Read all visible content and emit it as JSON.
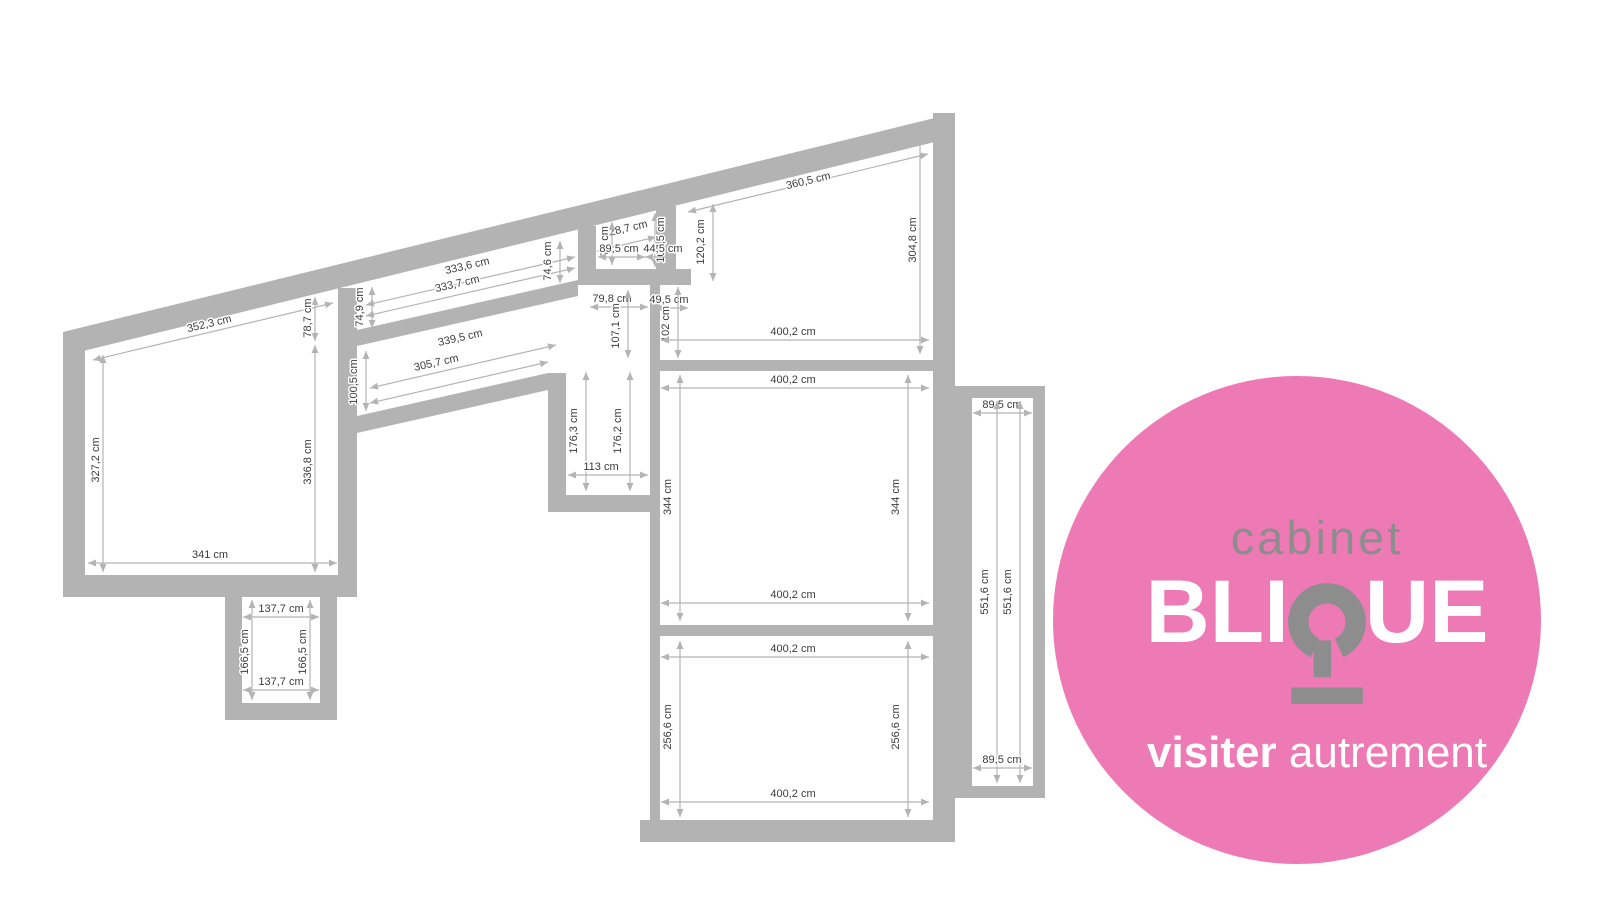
{
  "theme": {
    "pink": "#ee7ab5",
    "logo_gray": "#8d8d8d",
    "wall": "#b3b3b3",
    "dim_line": "#b4b4b4",
    "dim_text": "#3b3b3b"
  },
  "floorplan": {
    "unit": "cm",
    "dimensions": [
      {
        "label": "352,3 cm",
        "x1": 93,
        "y1": 360,
        "x2": 333,
        "y2": 303,
        "tx": 210,
        "ty": 327,
        "rot": -13.3
      },
      {
        "label": "78,7 cm",
        "x1": 315,
        "y1": 297,
        "x2": 315,
        "y2": 341,
        "tx": 311,
        "ty": 318,
        "rot": -90
      },
      {
        "label": "327,2 cm",
        "x1": 103,
        "y1": 355,
        "x2": 103,
        "y2": 572,
        "tx": 99,
        "ty": 460,
        "rot": -90
      },
      {
        "label": "336,8 cm",
        "x1": 315,
        "y1": 345,
        "x2": 315,
        "y2": 572,
        "tx": 311,
        "ty": 462,
        "rot": -90
      },
      {
        "label": "341 cm",
        "x1": 88,
        "y1": 563,
        "x2": 337,
        "y2": 563,
        "tx": 210,
        "ty": 558,
        "rot": 0
      },
      {
        "label": "137,7 cm",
        "x1": 243,
        "y1": 617,
        "x2": 319,
        "y2": 617,
        "tx": 281,
        "ty": 612,
        "rot": 0
      },
      {
        "label": "166,5 cm",
        "x1": 252,
        "y1": 600,
        "x2": 252,
        "y2": 700,
        "tx": 248,
        "ty": 652,
        "rot": -90
      },
      {
        "label": "166,5 cm",
        "x1": 310,
        "y1": 600,
        "x2": 310,
        "y2": 700,
        "tx": 306,
        "ty": 652,
        "rot": -90
      },
      {
        "label": "137,7 cm",
        "x1": 243,
        "y1": 690,
        "x2": 319,
        "y2": 690,
        "tx": 281,
        "ty": 685,
        "rot": 0
      },
      {
        "label": "333,6 cm",
        "x1": 366,
        "y1": 305,
        "x2": 575,
        "y2": 257,
        "tx": 468,
        "ty": 269,
        "rot": -13
      },
      {
        "label": "333,7 cm",
        "x1": 366,
        "y1": 316,
        "x2": 575,
        "y2": 268,
        "tx": 458,
        "ty": 287,
        "rot": -13
      },
      {
        "label": "74,9 cm",
        "x1": 372,
        "y1": 287,
        "x2": 372,
        "y2": 328,
        "tx": 363,
        "ty": 307,
        "rot": -90
      },
      {
        "label": "74,6 cm",
        "x1": 560,
        "y1": 241,
        "x2": 560,
        "y2": 283,
        "tx": 551,
        "ty": 261,
        "rot": -90
      },
      {
        "label": "339,5 cm",
        "x1": 370,
        "y1": 388,
        "x2": 556,
        "y2": 345,
        "tx": 461,
        "ty": 341,
        "rot": -12.8
      },
      {
        "label": "305,7 cm",
        "x1": 370,
        "y1": 403,
        "x2": 548,
        "y2": 362,
        "tx": 437,
        "ty": 366,
        "rot": -12.8
      },
      {
        "label": "100,5 cm",
        "x1": 366,
        "y1": 351,
        "x2": 366,
        "y2": 411,
        "tx": 357,
        "ty": 382,
        "rot": -90
      },
      {
        "label": "176,3 cm",
        "x1": 586,
        "y1": 372,
        "x2": 586,
        "y2": 491,
        "tx": 577,
        "ty": 431,
        "rot": -90
      },
      {
        "label": "176,2 cm",
        "x1": 630,
        "y1": 372,
        "x2": 630,
        "y2": 491,
        "tx": 621,
        "ty": 431,
        "rot": -90
      },
      {
        "label": "113 cm",
        "x1": 568,
        "y1": 475,
        "x2": 648,
        "y2": 475,
        "tx": 601,
        "ty": 470,
        "rot": 0
      },
      {
        "label": "79,8 cm",
        "x1": 590,
        "y1": 307,
        "x2": 648,
        "y2": 307,
        "tx": 612,
        "ty": 302,
        "rot": 0
      },
      {
        "label": "107,1 cm",
        "x1": 628,
        "y1": 290,
        "x2": 628,
        "y2": 358,
        "tx": 619,
        "ty": 326,
        "rot": -90
      },
      {
        "label": "49,5 cm",
        "x1": 655,
        "y1": 308,
        "x2": 688,
        "y2": 308,
        "tx": 669,
        "ty": 303,
        "rot": 0
      },
      {
        "label": "102 cm",
        "x1": 678,
        "y1": 287,
        "x2": 678,
        "y2": 358,
        "tx": 669,
        "ty": 324,
        "rot": -90
      },
      {
        "label": "128,7 cm",
        "x1": 597,
        "y1": 251,
        "x2": 656,
        "y2": 237,
        "tx": 626,
        "ty": 232,
        "rot": -13
      },
      {
        "label": "107,5 cm",
        "x1": 655,
        "y1": 213,
        "x2": 655,
        "y2": 267,
        "tx": 664,
        "ty": 240,
        "rot": -90
      },
      {
        "label": "76 cm",
        "x1": 612,
        "y1": 222,
        "x2": 612,
        "y2": 265,
        "tx": 608,
        "ty": 241,
        "rot": -90
      },
      {
        "label": "89,5 cm",
        "x1": 598,
        "y1": 257,
        "x2": 645,
        "y2": 257,
        "tx": 619,
        "ty": 252,
        "rot": 0
      },
      {
        "label": "44,5 cm",
        "x1": 645,
        "y1": 257,
        "x2": 676,
        "y2": 257,
        "tx": 663,
        "ty": 252,
        "rot": 0
      },
      {
        "label": "120,2 cm",
        "x1": 713,
        "y1": 204,
        "x2": 713,
        "y2": 281,
        "tx": 704,
        "ty": 242,
        "rot": -90
      },
      {
        "label": "360,5 cm",
        "x1": 688,
        "y1": 212,
        "x2": 928,
        "y2": 154,
        "tx": 809,
        "ty": 184,
        "rot": -13.3
      },
      {
        "label": "304,8 cm",
        "x1": 920,
        "y1": 133,
        "x2": 920,
        "y2": 354,
        "tx": 916,
        "ty": 240,
        "rot": -90
      },
      {
        "label": "400,2 cm",
        "x1": 661,
        "y1": 340,
        "x2": 929,
        "y2": 340,
        "tx": 793,
        "ty": 335,
        "rot": 0
      },
      {
        "label": "400,2 cm",
        "x1": 661,
        "y1": 388,
        "x2": 929,
        "y2": 388,
        "tx": 793,
        "ty": 383,
        "rot": 0
      },
      {
        "label": "344 cm",
        "x1": 680,
        "y1": 375,
        "x2": 680,
        "y2": 621,
        "tx": 671,
        "ty": 497,
        "rot": -90
      },
      {
        "label": "344 cm",
        "x1": 908,
        "y1": 375,
        "x2": 908,
        "y2": 621,
        "tx": 899,
        "ty": 497,
        "rot": -90
      },
      {
        "label": "400,2 cm",
        "x1": 661,
        "y1": 603,
        "x2": 929,
        "y2": 603,
        "tx": 793,
        "ty": 598,
        "rot": 0
      },
      {
        "label": "400,2 cm",
        "x1": 661,
        "y1": 657,
        "x2": 929,
        "y2": 657,
        "tx": 793,
        "ty": 652,
        "rot": 0
      },
      {
        "label": "256,6 cm",
        "x1": 680,
        "y1": 641,
        "x2": 680,
        "y2": 817,
        "tx": 671,
        "ty": 727,
        "rot": -90
      },
      {
        "label": "256,6 cm",
        "x1": 908,
        "y1": 641,
        "x2": 908,
        "y2": 817,
        "tx": 899,
        "ty": 727,
        "rot": -90
      },
      {
        "label": "400,2 cm",
        "x1": 661,
        "y1": 802,
        "x2": 929,
        "y2": 802,
        "tx": 793,
        "ty": 797,
        "rot": 0
      },
      {
        "label": "89,5 cm",
        "x1": 973,
        "y1": 413,
        "x2": 1032,
        "y2": 413,
        "tx": 1002,
        "ty": 408,
        "rot": 0
      },
      {
        "label": "551,6 cm",
        "x1": 997,
        "y1": 401,
        "x2": 997,
        "y2": 783,
        "tx": 988,
        "ty": 592,
        "rot": -90
      },
      {
        "label": "551,6 cm",
        "x1": 1020,
        "y1": 401,
        "x2": 1020,
        "y2": 783,
        "tx": 1011,
        "ty": 592,
        "rot": -90
      },
      {
        "label": "89,5 cm",
        "x1": 973,
        "y1": 768,
        "x2": 1032,
        "y2": 768,
        "tx": 1002,
        "ty": 763,
        "rot": 0
      }
    ]
  },
  "logo": {
    "bg_color": "#ee7ab5",
    "gray": "#8d8d8d",
    "top_word": "cabinet",
    "brand_prefix": "BLI",
    "brand_suffix": "UE",
    "tagline_bold": "visiter",
    "tagline_light": "autrement"
  }
}
